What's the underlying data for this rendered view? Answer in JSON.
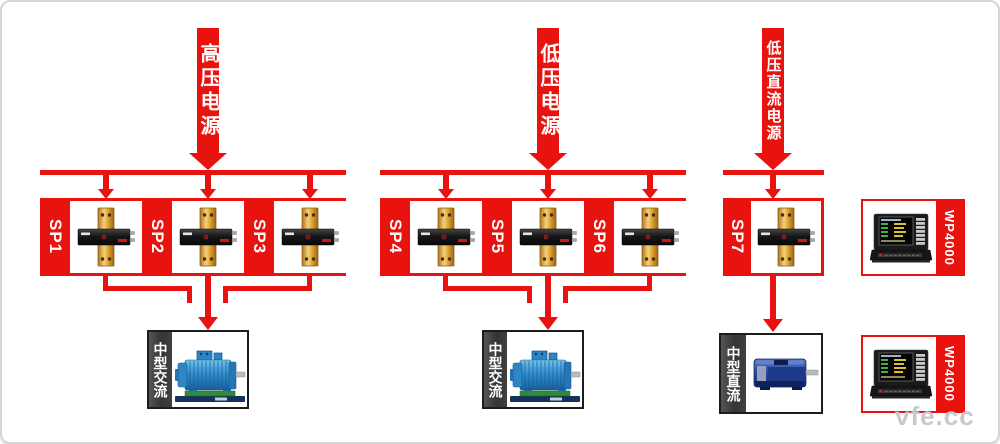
{
  "banners": [
    {
      "label": "高压电源"
    },
    {
      "label": "低压电源"
    },
    {
      "label": "低压直流电源"
    }
  ],
  "groups": [
    {
      "units": [
        {
          "label": "SP1"
        },
        {
          "label": "SP2"
        },
        {
          "label": "SP3"
        }
      ],
      "load": {
        "label": "中型交流",
        "type": "ac-motor"
      }
    },
    {
      "units": [
        {
          "label": "SP4"
        },
        {
          "label": "SP5"
        },
        {
          "label": "SP6"
        }
      ],
      "load": {
        "label": "中型交流",
        "type": "ac-motor"
      }
    },
    {
      "units": [
        {
          "label": "SP7"
        }
      ],
      "load": {
        "label": "中型直流",
        "type": "dc-motor"
      }
    }
  ],
  "analyzers": [
    {
      "label": "WP4000"
    },
    {
      "label": "WP4000"
    }
  ],
  "watermark": {
    "text": "vfe.cc"
  },
  "colors": {
    "red": "#e8120e",
    "box_border": "#1d1d1d",
    "label_strip_dark": "#3a3a3a",
    "busbar_gold": "#e8b84a",
    "ac_motor_blue": "#2f8fd0",
    "dc_motor_navy": "#27479e"
  }
}
